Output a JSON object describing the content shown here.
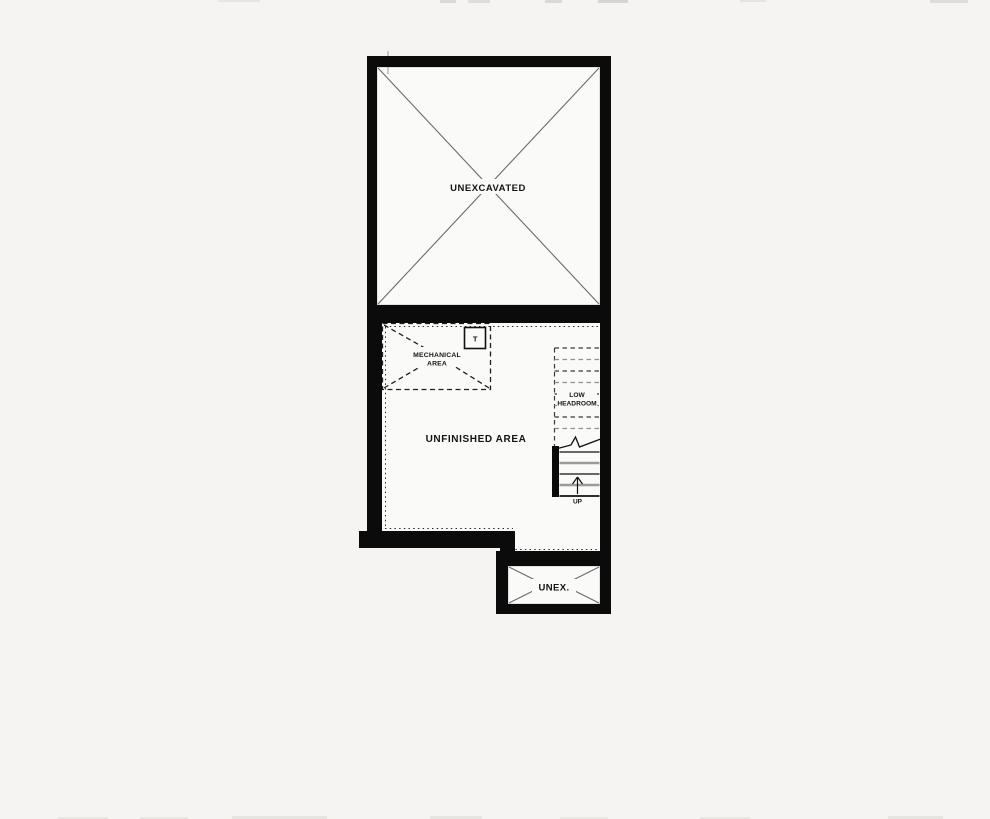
{
  "page": {
    "background": "#f5f4f2"
  },
  "plan": {
    "colors": {
      "wall": "#0b0b0b",
      "interior": "#fafaf8",
      "cross_line": "#6b6b6b",
      "dash_line": "#1f1f1f",
      "text": "#141414"
    },
    "unexcavated": {
      "label": "UNEXCAVATED"
    },
    "unfinished": {
      "label": "UNFINISHED AREA"
    },
    "mechanical": {
      "label_line1": "MECHANICAL",
      "label_line2": "AREA",
      "tank": "T"
    },
    "stairs": {
      "headroom_line1": "LOW",
      "headroom_line2": "HEADROOM",
      "direction": "UP"
    },
    "unex": {
      "label": "UNEX."
    }
  }
}
